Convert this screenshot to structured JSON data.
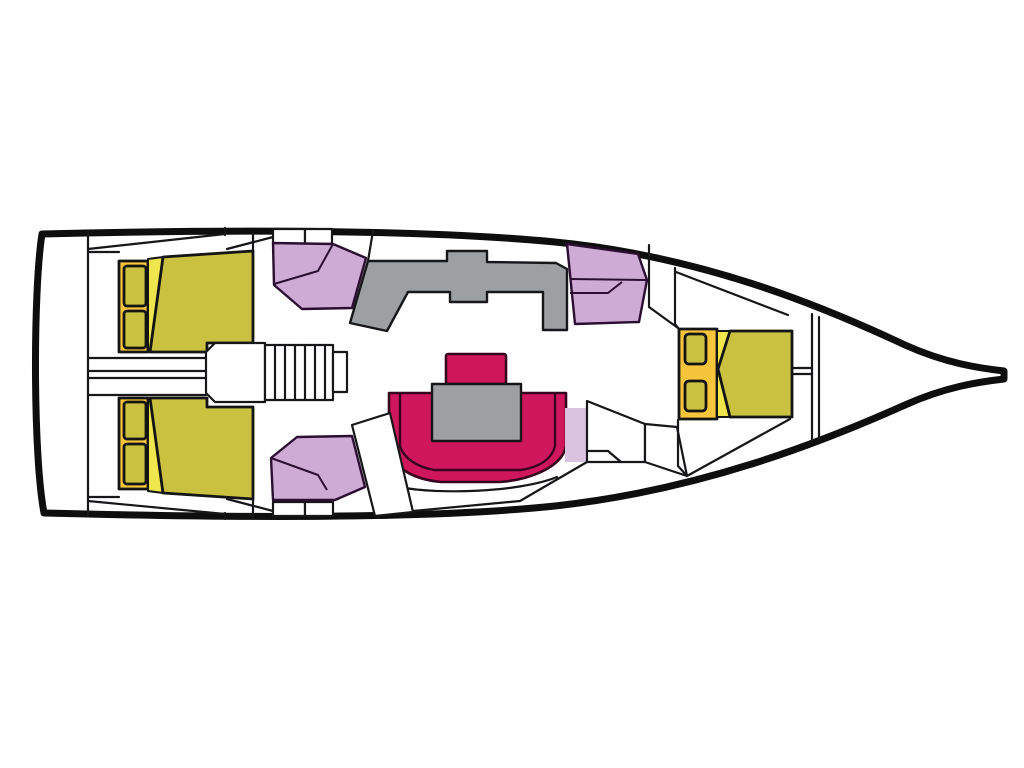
{
  "diagram": {
    "type": "yacht-floor-plan",
    "description": "Top-down interior layout plan of a sailing yacht monohull; stern at left, bow at right; no text labels in drawing",
    "orientation": {
      "stern": "left",
      "bow": "right"
    }
  },
  "colors": {
    "background": "#ffffff",
    "hull_outline": "#0e0e0e",
    "joinery_line": "#17171a",
    "berth_olive": "#c9c13f",
    "headboard_gold": "#f6c53c",
    "mattress_wedge_yellow": "#efe64e",
    "upholstery_purple": "#cdabd4",
    "upholstery_purple_light": "#d9c3e0",
    "dinette_magenta": "#d0175c",
    "table_gray": "#9da0a3",
    "white": "#ffffff"
  },
  "areas": {
    "transom_locker": "stern transom / lazarette",
    "aft_cabin_port": "aft double cabin (port, top)",
    "aft_cabin_starboard": "aft double cabin (starboard, bottom)",
    "companionway": "companionway steps between aft cabins",
    "salon_seat_port": "salon settee (port)",
    "salon_seat_starboard": "salon settee (starboard)",
    "galley": "galley counter (gray)",
    "nav_station": "chart table / nav seat (purple)",
    "dinette": "U-shaped dinette with table",
    "head_compartment": "head / wet locker doors",
    "forward_cabin": "forward double V-berth cabin",
    "anchor_locker": "bow anchor locker"
  }
}
